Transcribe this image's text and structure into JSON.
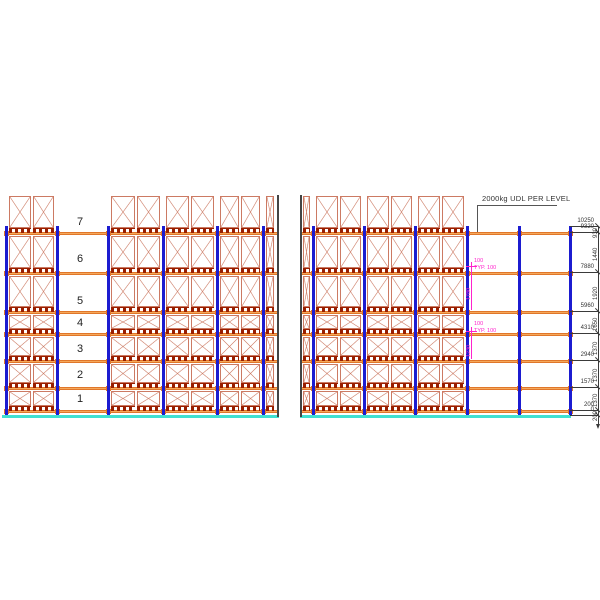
{
  "note": "2000kg UDL PER LEVEL",
  "left_view": {
    "level_labels": [
      "7",
      "6",
      "5",
      "4",
      "3",
      "2",
      "1"
    ]
  },
  "dimensions": {
    "elevation_labels": [
      "10250",
      "9320",
      "7880",
      "5960",
      "4310",
      "2940",
      "1570",
      "200",
      "0"
    ],
    "spacing_labels": [
      "930",
      "1440",
      "1920",
      "1650",
      "1370",
      "1370",
      "1370",
      "200"
    ]
  },
  "callouts": [
    {
      "beam_label": "100",
      "typ_label": "TYP. 100",
      "clear_label": "1780"
    },
    {
      "beam_label": "100",
      "typ_label": "TYP. 100",
      "clear_label": "1230"
    }
  ],
  "colors": {
    "upright": "#1C1CD0",
    "beam_fill": "#F5A85A",
    "beam_edge": "#E0762A",
    "box": "#CC7A63",
    "pallet": "#991E00",
    "floor": "#40E0D0",
    "dim": "#3A3A3A",
    "break_line": "#444444",
    "leader": "#555555",
    "magenta": "#FF22CC",
    "number": "#222222"
  }
}
